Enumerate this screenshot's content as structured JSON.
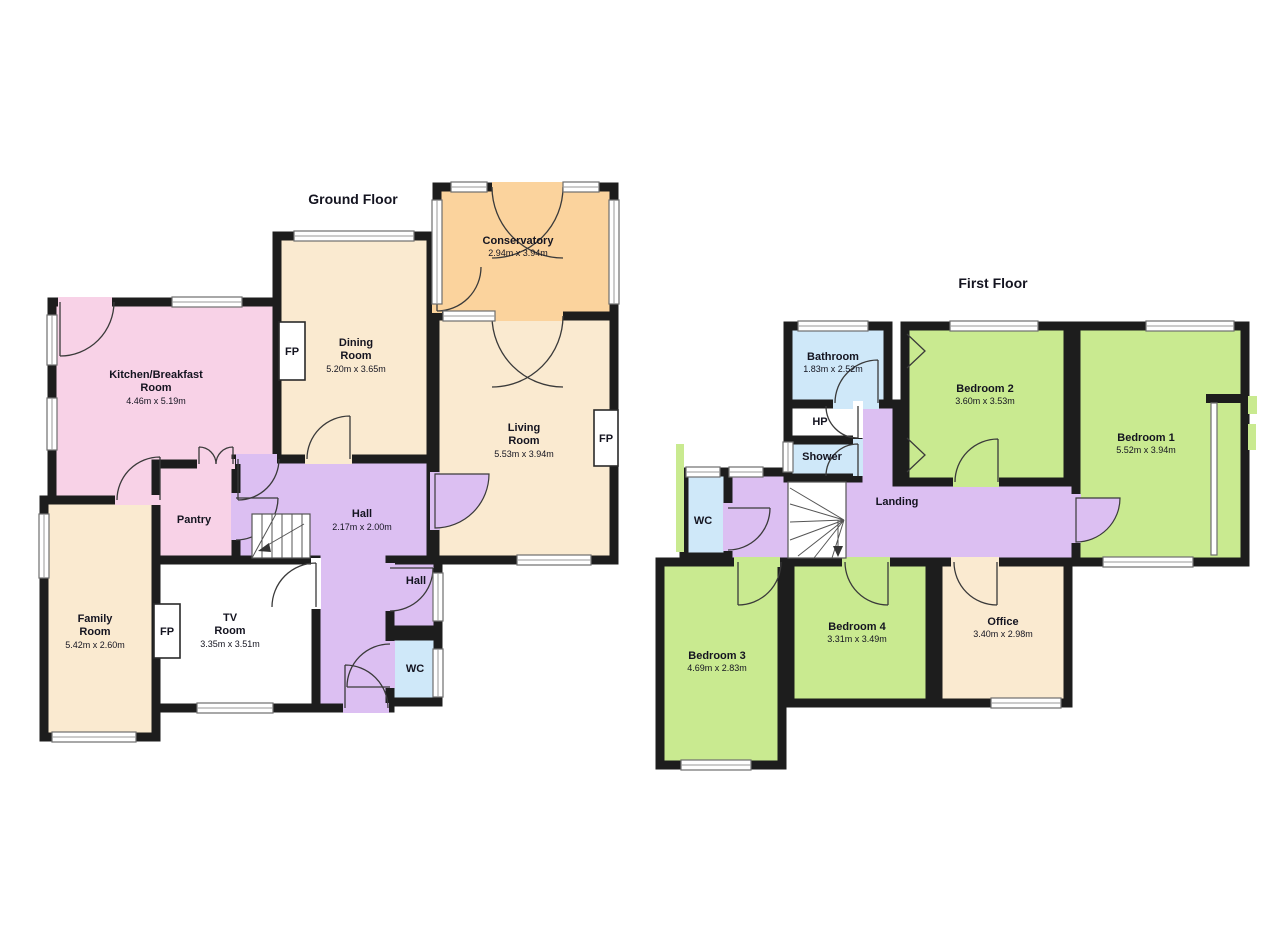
{
  "colors": {
    "wall": "#1d1d1d",
    "pink": "#f8d2e7",
    "cream": "#faead0",
    "orange": "#fbd39d",
    "purple": "#dcbff2",
    "green": "#c9ea90",
    "blue": "#cfe8f9"
  },
  "shared": {
    "fp": "FP"
  },
  "ground": {
    "title": "Ground Floor",
    "rooms": {
      "kitchen": {
        "lines": [
          "Kitchen/Breakfast",
          "Room"
        ],
        "dims": "4.46m x 5.19m"
      },
      "dining": {
        "lines": [
          "Dining",
          "Room"
        ],
        "dims": "5.20m x 3.65m"
      },
      "conservatory": {
        "lines": [
          "Conservatory"
        ],
        "dims": "2.94m x 3.94m"
      },
      "living": {
        "lines": [
          "Living",
          "Room"
        ],
        "dims": "5.53m x 3.94m"
      },
      "hall": {
        "lines": [
          "Hall"
        ],
        "dims": "2.17m x 2.00m"
      },
      "pantry": {
        "lines": [
          "Pantry"
        ]
      },
      "family": {
        "lines": [
          "Family",
          "Room"
        ],
        "dims": "5.42m x 2.60m"
      },
      "tv": {
        "lines": [
          "TV",
          "Room"
        ],
        "dims": "3.35m x 3.51m"
      },
      "hall2": {
        "lines": [
          "Hall"
        ]
      },
      "wc": {
        "lines": [
          "WC"
        ]
      }
    }
  },
  "first": {
    "title": "First Floor",
    "rooms": {
      "bathroom": {
        "lines": [
          "Bathroom"
        ],
        "dims": "1.83m x 2.52m"
      },
      "hp": {
        "lines": [
          "HP"
        ]
      },
      "shower": {
        "lines": [
          "Shower"
        ]
      },
      "bedroom2": {
        "lines": [
          "Bedroom 2"
        ],
        "dims": "3.60m x 3.53m"
      },
      "bedroom1": {
        "lines": [
          "Bedroom 1"
        ],
        "dims": "5.52m x 3.94m"
      },
      "landing": {
        "lines": [
          "Landing"
        ]
      },
      "wc": {
        "lines": [
          "WC"
        ]
      },
      "bedroom3": {
        "lines": [
          "Bedroom 3"
        ],
        "dims": "4.69m x 2.83m"
      },
      "bedroom4": {
        "lines": [
          "Bedroom 4"
        ],
        "dims": "3.31m x 3.49m"
      },
      "office": {
        "lines": [
          "Office"
        ],
        "dims": "3.40m x 2.98m"
      }
    }
  }
}
